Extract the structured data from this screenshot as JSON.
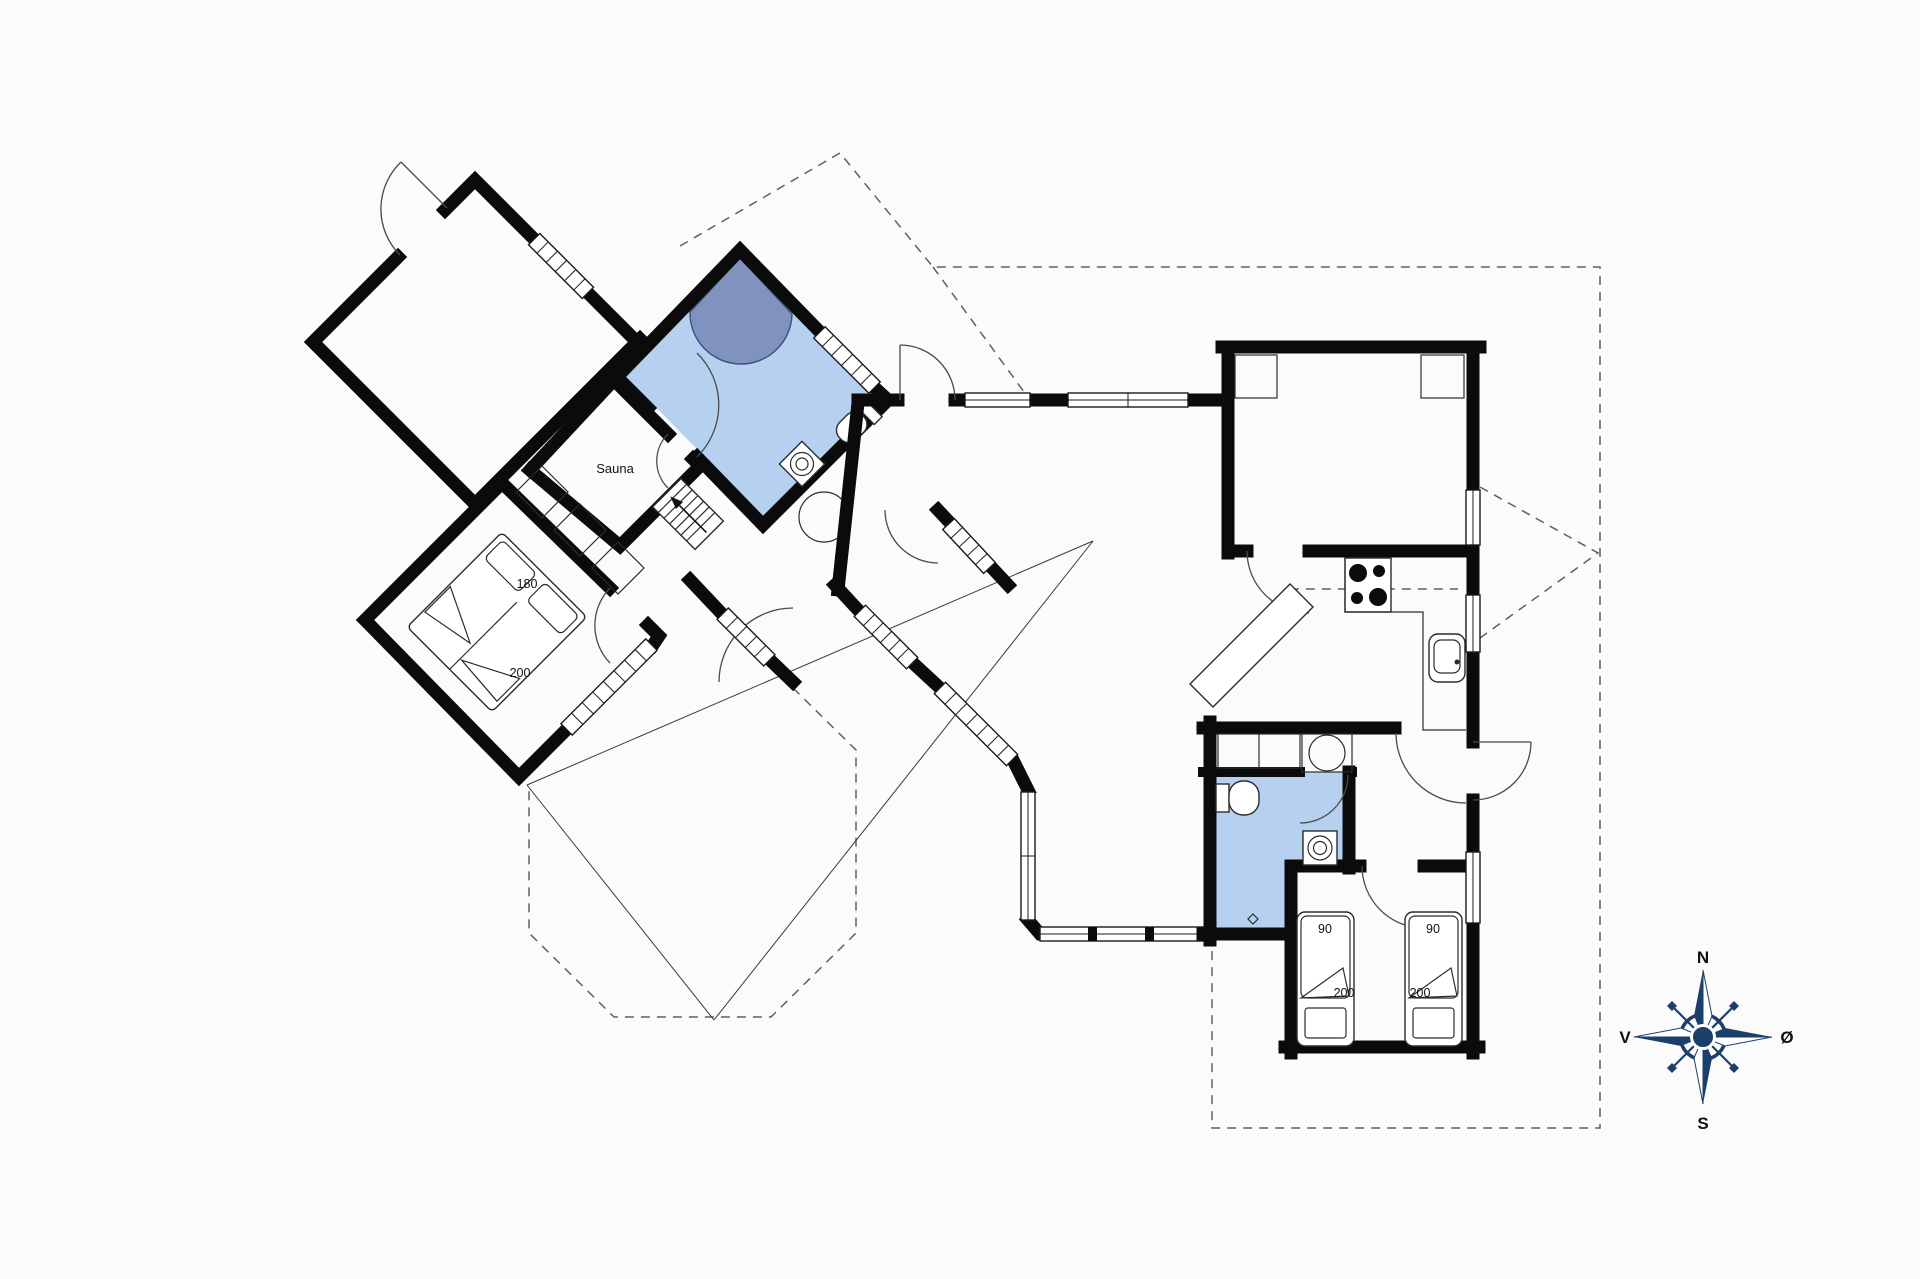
{
  "floorplan": {
    "rooms": {
      "sauna_label": "Sauna"
    },
    "master_bed": {
      "width_label": "180",
      "length_label": "200"
    },
    "twin_beds": [
      {
        "width_label": "90",
        "length_label": "200"
      },
      {
        "width_label": "90",
        "length_label": "200"
      }
    ],
    "compass": {
      "north": "N",
      "south": "S",
      "west": "V",
      "east": "Ø"
    },
    "colors": {
      "wall": "#0b0b0b",
      "bathroom_fill": "#b6d0ef",
      "shower_fill": "#8093bf",
      "compass_navy": "#1c3e6b",
      "dashed_line": "#606060"
    }
  }
}
